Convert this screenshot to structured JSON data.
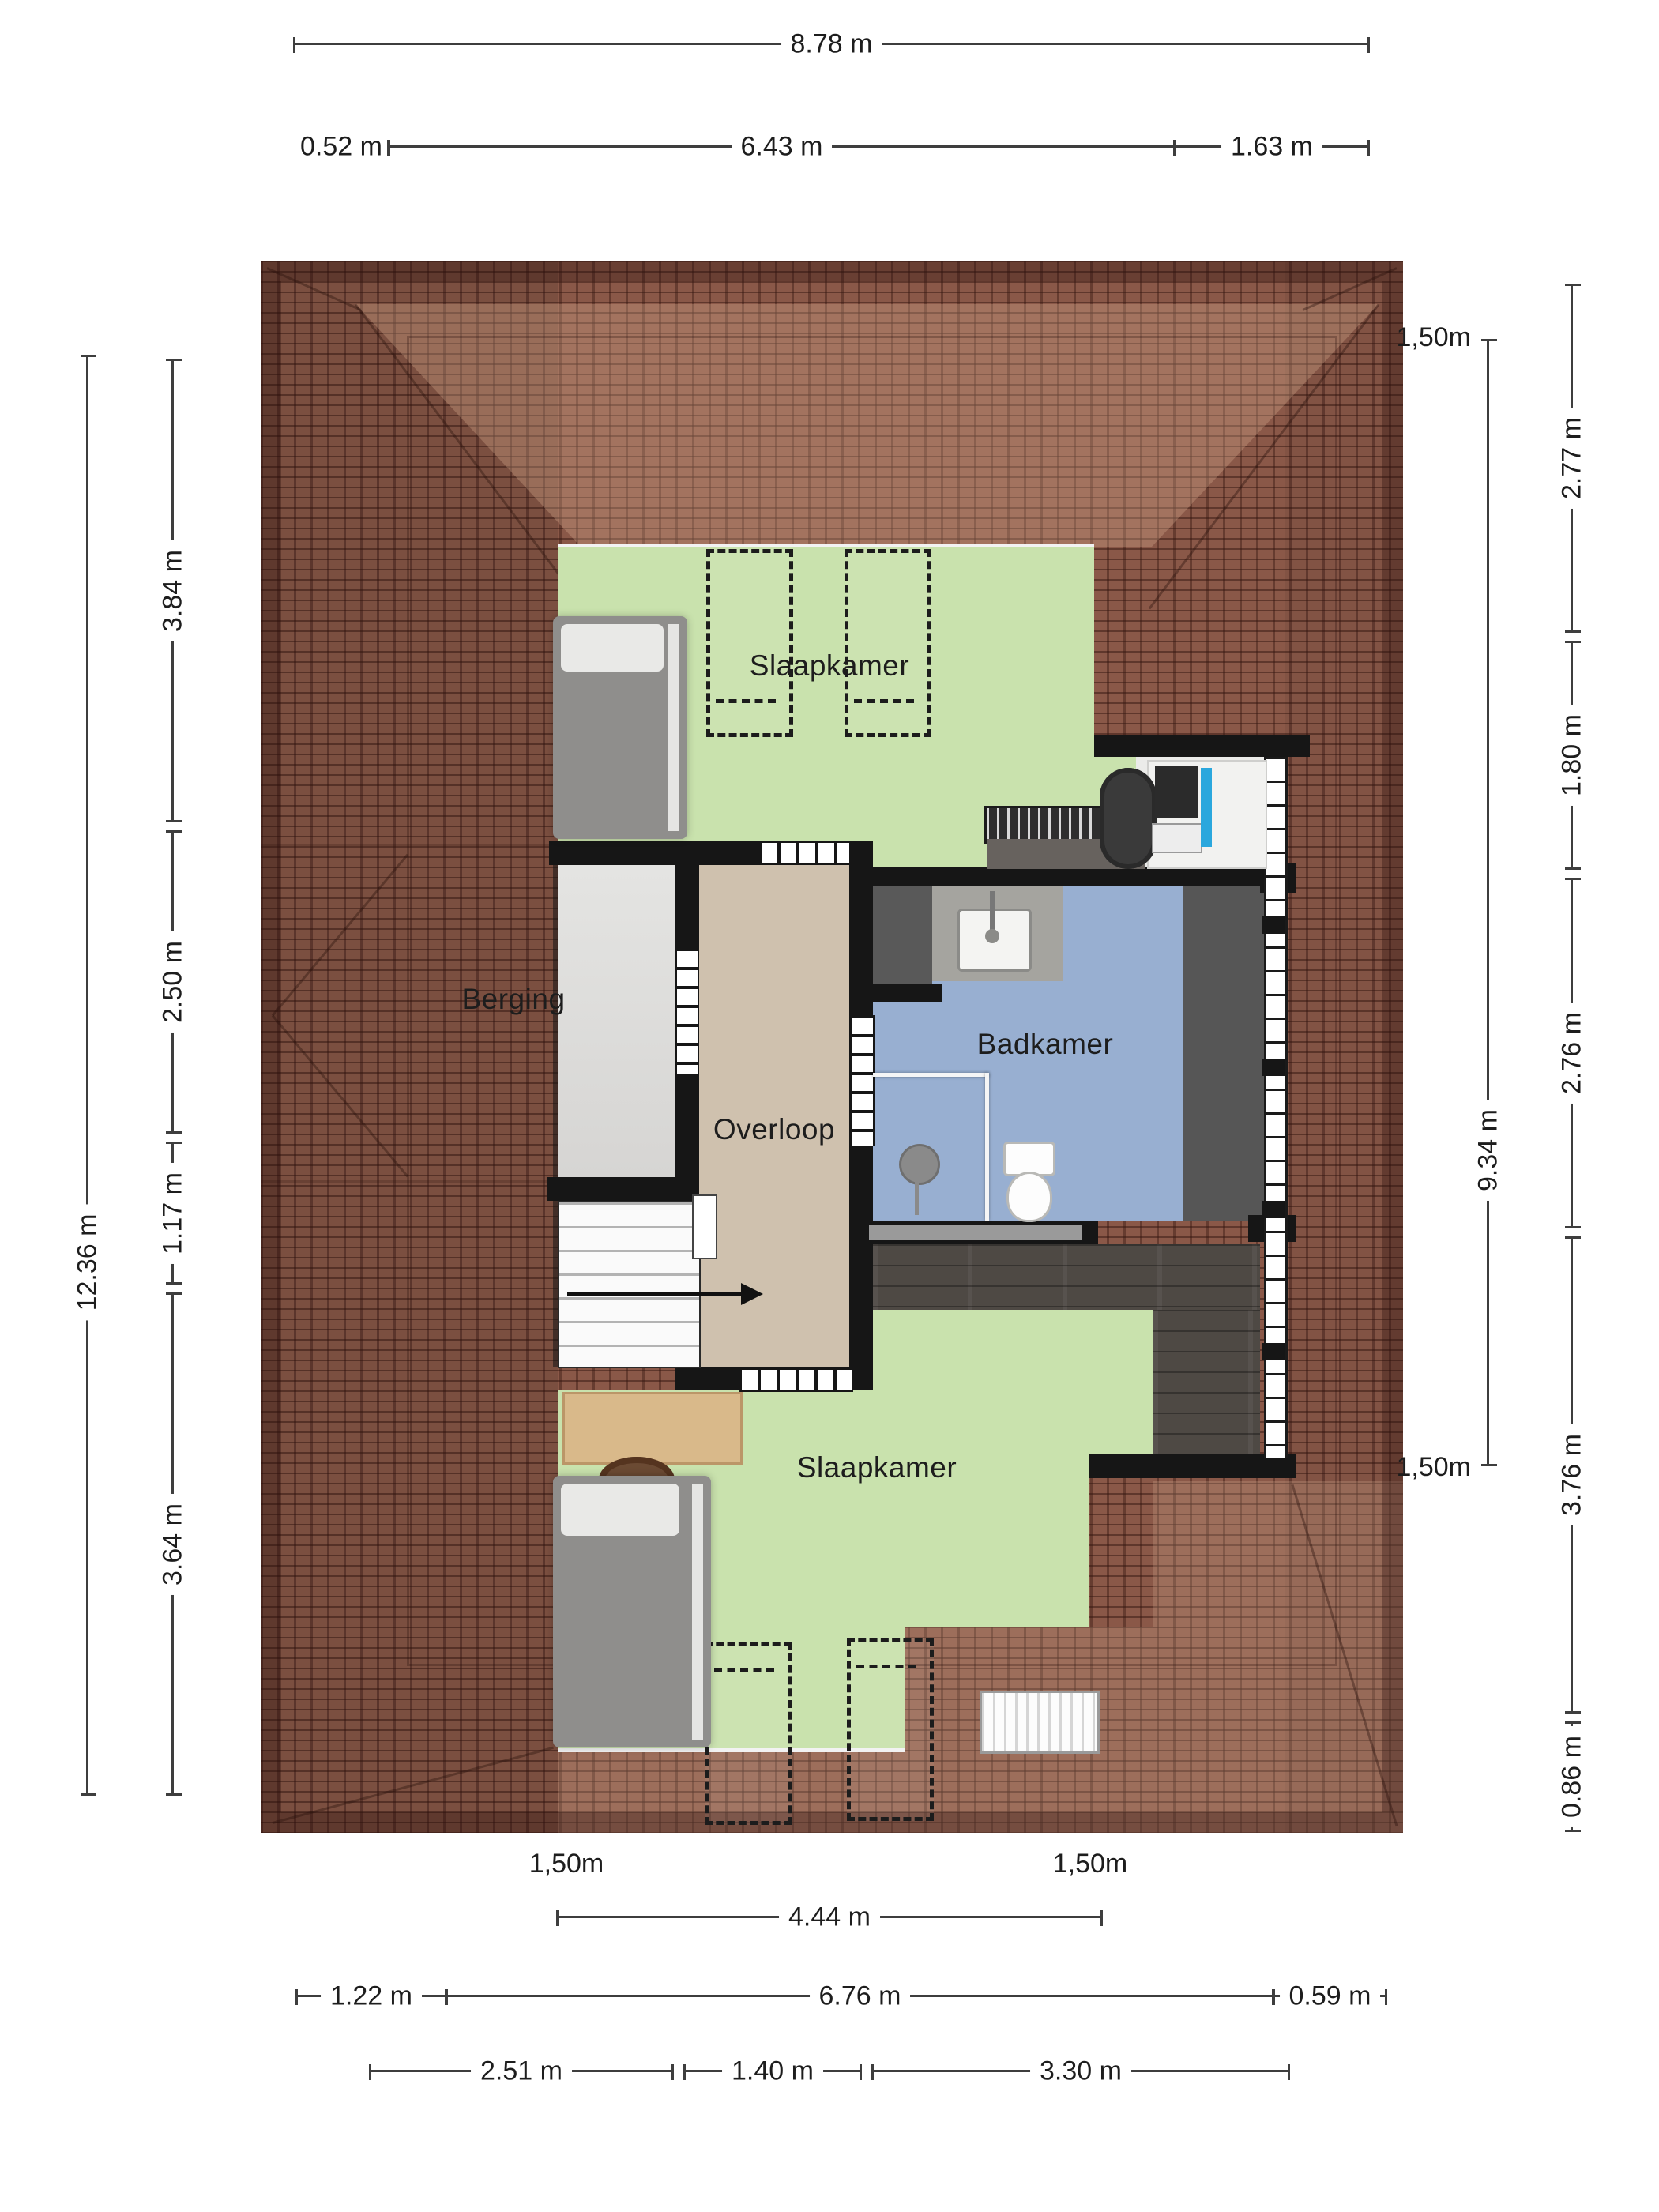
{
  "document": {
    "type": "floorplan",
    "floor": "attic / first floor",
    "language": "nl"
  },
  "rooms": {
    "bedroom_top": "Slaapkamer",
    "storage": "Berging",
    "landing": "Overloop",
    "bathroom": "Badkamer",
    "bedroom_bottom": "Slaapkamer"
  },
  "dims": {
    "top_total": "8.78 m",
    "top_segments": [
      "0.52 m",
      "6.43 m",
      "1.63 m"
    ],
    "left_total": "12.36 m",
    "left_segments": [
      "3.84 m",
      "2.50 m",
      "1.17 m",
      "3.64 m"
    ],
    "right_headroom": {
      "marker_top": "1,50m",
      "length_label": "9.34 m",
      "marker_bottom": "1,50m"
    },
    "right_segments": [
      "2.77 m",
      "1.80 m",
      "2.76 m",
      "3.76 m",
      "0.86 m"
    ],
    "bottom_markers": [
      "1,50m",
      "1,50m"
    ],
    "bottom_width": "4.44 m",
    "bottom_row2": [
      "1.22 m",
      "6.76 m",
      "0.59 m"
    ],
    "bottom_row3": [
      "2.51 m",
      "1.40 m",
      "3.30 m"
    ]
  },
  "colors": {
    "roof": "#8a5848",
    "roof_light_slope": "#a87f63",
    "floor_bedroom": "#c9e2ad",
    "floor_landing": "#cfc1ae",
    "floor_storage": "#dedddb",
    "floor_bathroom": "#98afd1",
    "floor_wood": "#4e4944",
    "wall": "#161616",
    "monitor_screen": "#2aa7dd",
    "desk_wood": "#d9b98a"
  },
  "icons": [
    "stairs-direction-arrow-icon",
    "bed-icon",
    "desk-icon",
    "office-chair-icon",
    "monitor-icon",
    "keyboard-icon",
    "radiator-icon",
    "sink-icon",
    "faucet-icon",
    "toilet-icon",
    "shower-head-icon",
    "roof-window-icon",
    "door-opening",
    "window-strip"
  ]
}
